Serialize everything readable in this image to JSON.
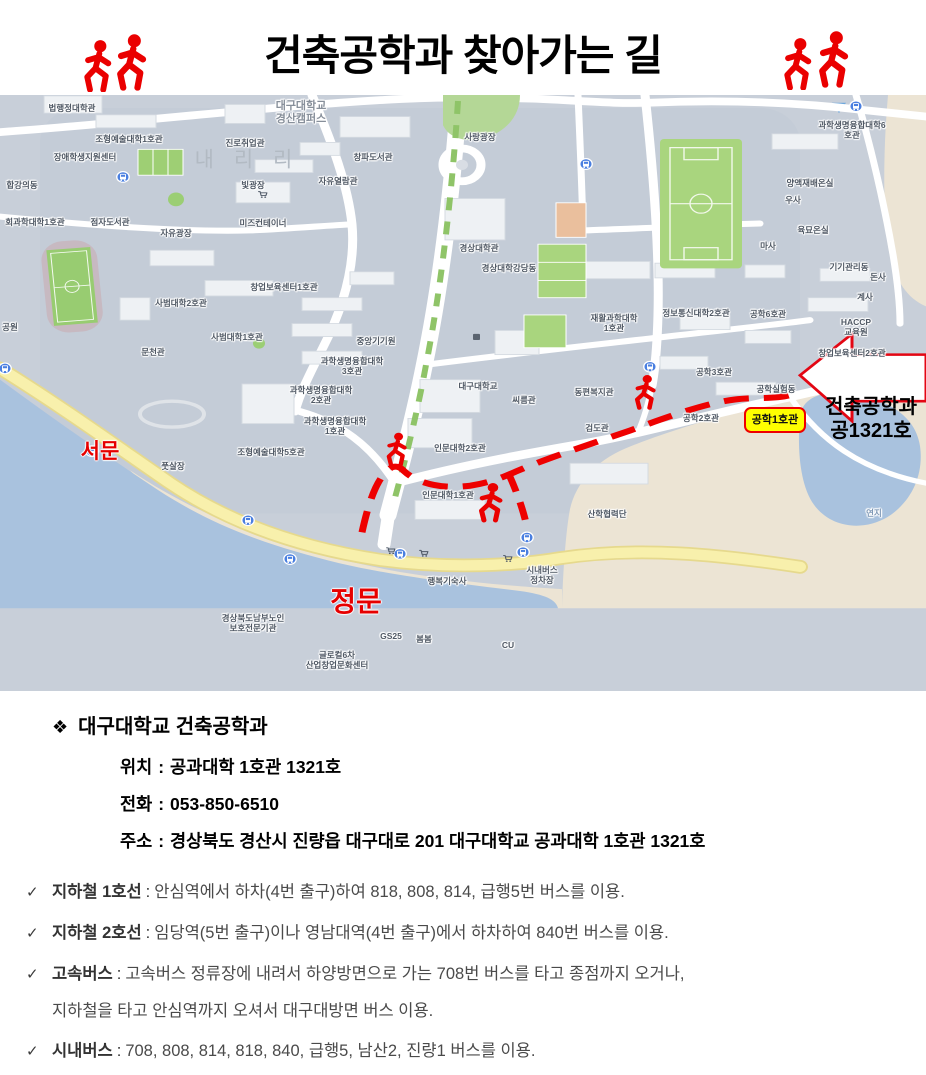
{
  "title": "건축공학과 찾아가는 길",
  "colors": {
    "accent_red": "#ea0000",
    "badge_yellow": "#ffff00",
    "map_land": "#c8cfd9",
    "map_water": "#a9c2de",
    "map_beige": "#ece4d4",
    "road_yellow": "#f8f0ac",
    "field_green": "#a9d57e"
  },
  "map": {
    "campus_title": "대구대학교\n경산캠퍼스",
    "area_name": "내 리 리",
    "red_labels": {
      "west_gate": "서문",
      "main_gate": "정문"
    },
    "building_badge": "공학1호관",
    "callout": {
      "line1": "건축공학과",
      "line2": "공1321호"
    },
    "labels": [
      {
        "t": "법행정대학관",
        "x": 72,
        "y": 13
      },
      {
        "t": "조형예술대학1호관",
        "x": 129,
        "y": 44
      },
      {
        "t": "장애학생지원센터",
        "x": 85,
        "y": 62
      },
      {
        "t": "합강의동",
        "x": 22,
        "y": 90
      },
      {
        "t": "회과학대학1호관",
        "x": 35,
        "y": 127
      },
      {
        "t": "점자도서관",
        "x": 110,
        "y": 127
      },
      {
        "t": "자유광장",
        "x": 176,
        "y": 138
      },
      {
        "t": "공원",
        "x": 10,
        "y": 232
      },
      {
        "t": "진로취업관",
        "x": 245,
        "y": 48
      },
      {
        "t": "빛광장",
        "x": 253,
        "y": 90
      },
      {
        "t": "미즈컨테이너",
        "x": 263,
        "y": 128
      },
      {
        "t": "창파도서관",
        "x": 373,
        "y": 62
      },
      {
        "t": "자유열람관",
        "x": 338,
        "y": 86
      },
      {
        "t": "사랑광장",
        "x": 480,
        "y": 42
      },
      {
        "t": "과학생명융합대학6호관",
        "x": 852,
        "y": 35
      },
      {
        "t": "양액재배온실",
        "x": 810,
        "y": 88
      },
      {
        "t": "우사",
        "x": 793,
        "y": 105
      },
      {
        "t": "육묘온실",
        "x": 813,
        "y": 135
      },
      {
        "t": "마사",
        "x": 768,
        "y": 151
      },
      {
        "t": "기기관리동",
        "x": 849,
        "y": 172
      },
      {
        "t": "돈사",
        "x": 878,
        "y": 182
      },
      {
        "t": "계사",
        "x": 865,
        "y": 202
      },
      {
        "t": "HACCP\n교육원",
        "x": 856,
        "y": 232
      },
      {
        "t": "창업보육센터2호관",
        "x": 852,
        "y": 258
      },
      {
        "t": "공학6호관",
        "x": 768,
        "y": 219
      },
      {
        "t": "정보통신대학2호관",
        "x": 696,
        "y": 218
      },
      {
        "t": "공학3호관",
        "x": 714,
        "y": 277
      },
      {
        "t": "공학실험동",
        "x": 776,
        "y": 294
      },
      {
        "t": "공학2호관",
        "x": 701,
        "y": 323
      },
      {
        "t": "경상대학관",
        "x": 479,
        "y": 153
      },
      {
        "t": "경상대학강당동",
        "x": 509,
        "y": 173
      },
      {
        "t": "재활과학대학\n1호관",
        "x": 614,
        "y": 228
      },
      {
        "t": "사범대학2호관",
        "x": 181,
        "y": 208
      },
      {
        "t": "사범대학1호관",
        "x": 237,
        "y": 242
      },
      {
        "t": "문천관",
        "x": 153,
        "y": 257
      },
      {
        "t": "창업보육센터1호관",
        "x": 284,
        "y": 192
      },
      {
        "t": "중앙기기원",
        "x": 376,
        "y": 246
      },
      {
        "t": "과학생명융합대학\n3호관",
        "x": 352,
        "y": 271
      },
      {
        "t": "과학생명융합대학\n2호관",
        "x": 321,
        "y": 300
      },
      {
        "t": "과학생명융합대학\n1호관",
        "x": 335,
        "y": 331
      },
      {
        "t": "조형예술대학5호관",
        "x": 271,
        "y": 357
      },
      {
        "t": "풋살장",
        "x": 173,
        "y": 371
      },
      {
        "t": "대구대학교",
        "x": 478,
        "y": 291
      },
      {
        "t": "씨름관",
        "x": 524,
        "y": 305
      },
      {
        "t": "동편복지관",
        "x": 594,
        "y": 297
      },
      {
        "t": "검도관",
        "x": 597,
        "y": 333
      },
      {
        "t": "인문대학2호관",
        "x": 460,
        "y": 353
      },
      {
        "t": "인문대학1호관",
        "x": 448,
        "y": 400
      },
      {
        "t": "산학협력단",
        "x": 607,
        "y": 419
      },
      {
        "t": "행복기숙사",
        "x": 447,
        "y": 486
      },
      {
        "t": "시내버스\n정차장",
        "x": 542,
        "y": 480
      },
      {
        "t": "경상북도남부노인\n보호전문기관",
        "x": 253,
        "y": 528
      },
      {
        "t": "GS25",
        "x": 391,
        "y": 541
      },
      {
        "t": "봄봄",
        "x": 424,
        "y": 544
      },
      {
        "t": "글로컬6차\n산업창업문화센터",
        "x": 337,
        "y": 565
      },
      {
        "t": "CU",
        "x": 508,
        "y": 550
      },
      {
        "t": "연지",
        "x": 874,
        "y": 418,
        "cls": "water"
      }
    ],
    "bus_stops": [
      [
        5,
        317
      ],
      [
        92,
        413
      ],
      [
        123,
        95
      ],
      [
        586,
        80
      ],
      [
        650,
        315
      ],
      [
        248,
        493
      ],
      [
        290,
        538
      ],
      [
        400,
        532
      ],
      [
        527,
        513
      ],
      [
        523,
        530
      ],
      [
        856,
        13
      ]
    ],
    "store_icons": [
      [
        391,
        533
      ],
      [
        424,
        536
      ],
      [
        508,
        542
      ],
      [
        263,
        120
      ]
    ]
  },
  "info": {
    "bullet": "❖",
    "heading": "대구대학교 건축공학과",
    "colon_separator": ":",
    "rows": [
      {
        "label": "위치",
        "value": "공과대학 1호관 1321호"
      },
      {
        "label": "전화",
        "value": "053-850-6510"
      },
      {
        "label": "주소",
        "value": "경상북도 경산시 진량읍 대구대로 201 대구대학교 공과대학 1호관 1321호"
      }
    ]
  },
  "transit": {
    "check": "✓",
    "colon_separator": ":",
    "items": [
      {
        "label": "지하철 1호선",
        "text": "안심역에서 하차(4번 출구)하여 818, 808, 814, 급행5번 버스를 이용."
      },
      {
        "label": "지하철 2호선",
        "text": "임당역(5번 출구)이나 영남대역(4번 출구)에서 하차하여 840번 버스를 이용."
      },
      {
        "label": "고속버스",
        "text": "고속버스 정류장에 내려서 하양방면으로 가는 708번 버스를 타고 종점까지 오거나,",
        "text2": "지하철을 타고 안심역까지 오셔서 대구대방면 버스 이용."
      },
      {
        "label": "시내버스",
        "text": "708, 808, 814, 818, 840, 급행5, 남산2, 진량1 버스를 이용."
      }
    ]
  }
}
